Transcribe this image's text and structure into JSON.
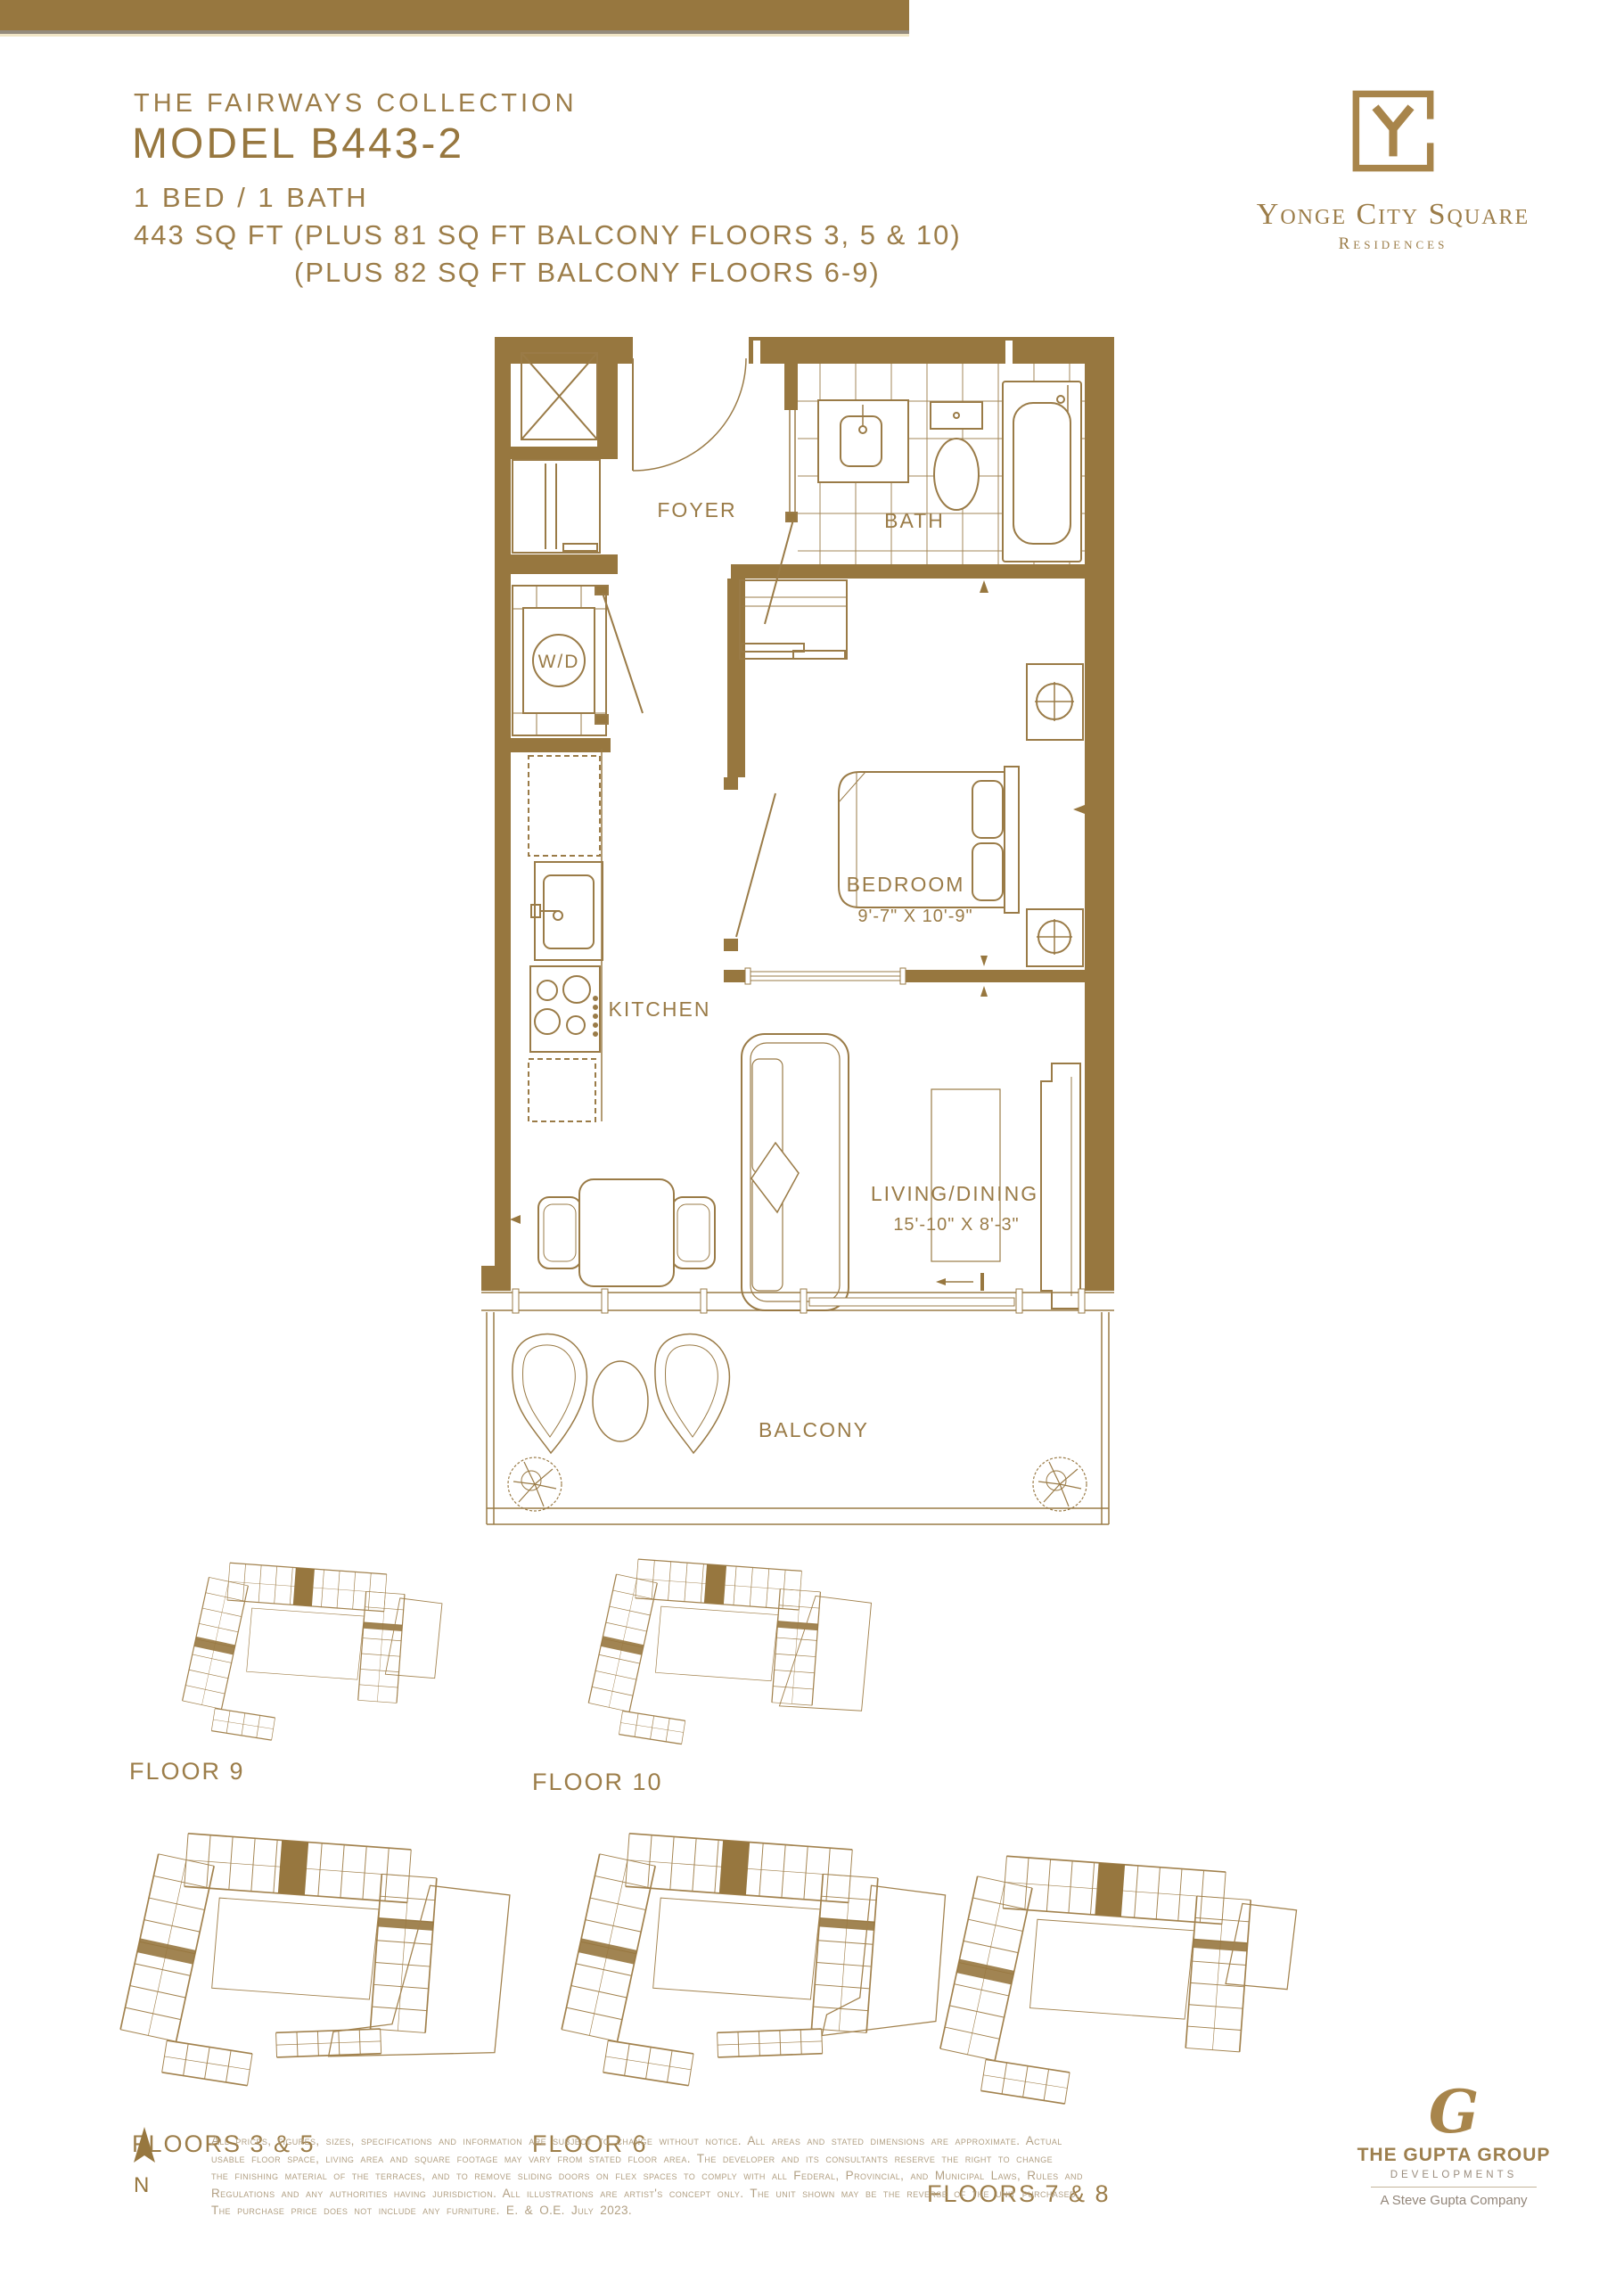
{
  "colors": {
    "gold": "#97773F",
    "gold_text": "#9C7D49",
    "line_gold": "#A2824E",
    "disclaimer_text": "#B2A084",
    "tagline_gray": "#93867A"
  },
  "header": {
    "collection": "THE FAIRWAYS COLLECTION",
    "model": "MODEL B443-2",
    "beds": "1 BED / 1 BATH",
    "area_line1": "443 SQ FT (PLUS 81 SQ FT BALCONY FLOORS 3, 5 & 10)",
    "area_line2": "(PLUS 82 SQ FT BALCONY FLOORS 6-9)"
  },
  "brand": {
    "name": "Yonge City Square",
    "sub": "Residences"
  },
  "plan": {
    "rooms": {
      "foyer": "FOYER",
      "bath": "BATH",
      "wd": "W/D",
      "kitchen": "KITCHEN",
      "bedroom": "BEDROOM",
      "bedroom_dim": "9'-7\" X 10'-9\"",
      "living": "LIVING/DINING",
      "living_dim": "15'-10\" X 8'-3\"",
      "balcony": "BALCONY"
    }
  },
  "keyplans": [
    {
      "label": "FLOOR 9"
    },
    {
      "label": "FLOOR 10"
    },
    {
      "label": "FLOORS 3 & 5"
    },
    {
      "label": "FLOOR 6"
    },
    {
      "label": "FLOORS 7 & 8"
    }
  ],
  "north": {
    "label": "N"
  },
  "disclaimer": {
    "lines": [
      "All prices, figures, sizes, specifications and information are subject to change without notice. All areas and stated dimensions are approximate. Actual",
      "usable floor space, living area and square footage may vary from stated floor area. The developer and its consultants reserve the right to change",
      "the finishing material of the terraces, and to remove sliding doors on flex spaces to comply with all Federal, Provincial, and Municipal Laws, Rules and",
      "Regulations and any authorities having jurisdiction. All illustrations are artist's concept only. The unit shown may be the reverse of the unit purchased.",
      "The purchase price does not include any furniture. E. & O.E. July 2023."
    ]
  },
  "developer": {
    "monogram": "G",
    "name": "THE GUPTA GROUP",
    "division": "DEVELOPMENTS",
    "tagline": "A Steve Gupta Company"
  }
}
